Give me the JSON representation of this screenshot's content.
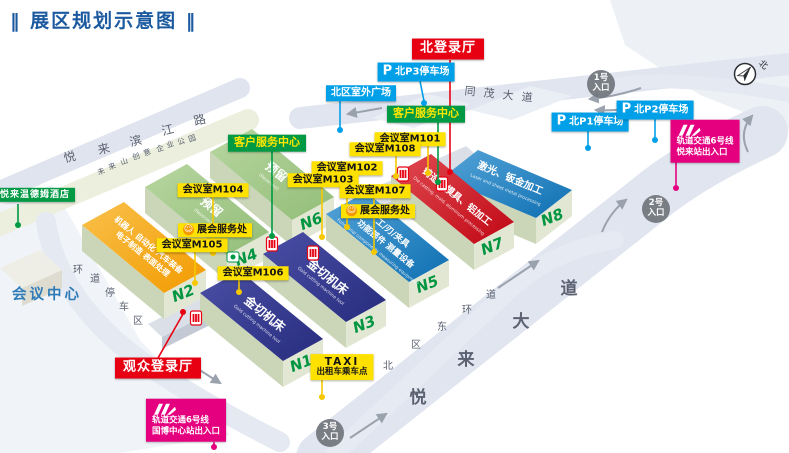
{
  "title": {
    "decor_left": "‖",
    "text": "展区规划示意图",
    "decor_right": "‖"
  },
  "colors": {
    "title_blue": "#1c5aa0",
    "badge_red": "#e60012",
    "badge_blue": "#00a0e9",
    "badge_green": "#009944",
    "badge_yellow": "#ffe100",
    "badge_magenta": "#e4007f",
    "hall_navy": "#2e3192",
    "hall_orange": "#f6ab00",
    "hall_green": "#a6cb8d",
    "hall_blue": "#1b7fc0",
    "hall_red": "#d0121b",
    "hall_label_green": "#009540",
    "road_fill": "#e0e5f0"
  },
  "halls": {
    "n1": {
      "id": "N1",
      "line1": "金切机床",
      "sub": "Gold cutting machine tool"
    },
    "n2": {
      "id": "N2",
      "line1": "机器人 自动化 汽车装备",
      "line2": "电子制造 表面处理"
    },
    "n3": {
      "id": "N3",
      "line1": "金切机床",
      "sub": "Gold cutting machine tool"
    },
    "n4": {
      "id": "N4",
      "line1": "预留",
      "sub": "(Reserved)"
    },
    "n5": {
      "id": "N5",
      "line1": "工/刃/夹具",
      "line2": "功能部件 测量设备",
      "sub": "Functional components measuring equipment"
    },
    "n6": {
      "id": "N6",
      "line1": "预留",
      "sub": "(Reserved)"
    },
    "n7": {
      "id": "N7",
      "line1": "铸造、模具、铝加工",
      "sub": "Die casting, mold, aluminum processing"
    },
    "n8": {
      "id": "N8",
      "line1": "激光、钣金加工",
      "sub": "Laser and sheet metal processing"
    }
  },
  "badges": {
    "north_hall": "北登录厅",
    "visitor_hall": "观众登录厅",
    "north_plaza": "北区室外广场",
    "customer_service": "客户服务中心",
    "expo_service": "展会服务处",
    "hotel": "悦来温德姆酒店",
    "conference_center": "会议中心",
    "taxi_line1": "TAXI",
    "taxi_line2": "出租车乘车点"
  },
  "parking": {
    "p": "P",
    "p1": "北P1停车场",
    "p2": "北P2停车场",
    "p3": "北P3停车场"
  },
  "meeting_rooms": {
    "m101": "会议室M101",
    "m102": "会议室M102",
    "m103": "会议室M103",
    "m104": "会议室M104",
    "m105": "会议室M105",
    "m106": "会议室M106",
    "m107": "会议室M107",
    "m108": "会议室M108"
  },
  "metro": {
    "line": "轨道交通6号线",
    "station_yuelai": "悦来站出入口",
    "station_guobo": "国博中心站出入口"
  },
  "entrances": {
    "e1": "1号",
    "e2": "2号",
    "e3": "3号",
    "suffix": "入口"
  },
  "roads": {
    "tongmao": [
      "同",
      "茂",
      "大",
      "道"
    ],
    "yuelai": [
      "悦",
      "来",
      "大",
      "道"
    ],
    "ring_east": [
      "北",
      "区",
      "东",
      "环",
      "道"
    ],
    "binjiang": [
      "悦",
      "来",
      "滨",
      "江",
      "路"
    ],
    "park": [
      "未",
      "来",
      "山",
      "创",
      "意",
      "企",
      "业",
      "公",
      "园"
    ],
    "ring_parking": [
      "环",
      "道",
      "停",
      "车",
      "区"
    ]
  },
  "compass": {
    "north": "北"
  }
}
